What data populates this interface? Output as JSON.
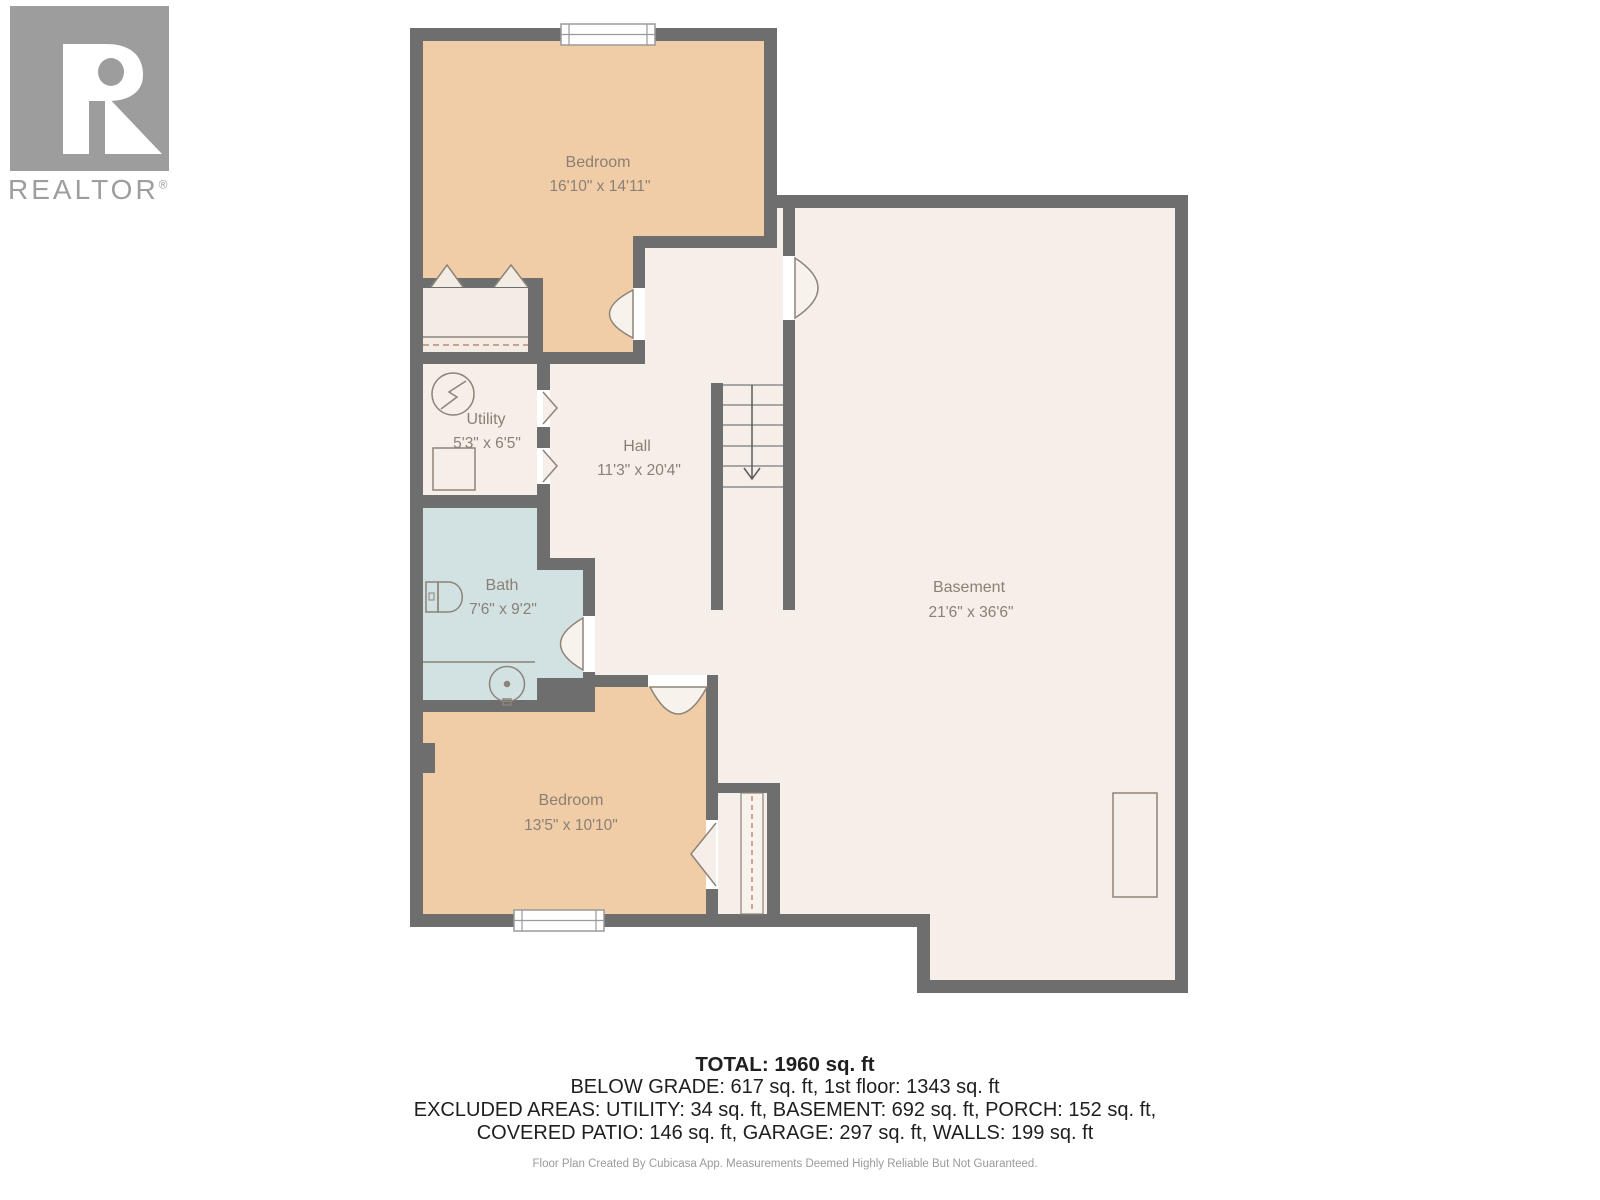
{
  "logo": {
    "brand": "REALTOR",
    "registered": "®"
  },
  "rooms": {
    "bedroom1": {
      "name": "Bedroom",
      "dims": "16'10\" x 14'11\""
    },
    "utility": {
      "name": "Utility",
      "dims": "5'3\" x 6'5\""
    },
    "hall": {
      "name": "Hall",
      "dims": "11'3\" x 20'4\""
    },
    "bath": {
      "name": "Bath",
      "dims": "7'6\" x 9'2\""
    },
    "bedroom2": {
      "name": "Bedroom",
      "dims": "13'5\" x 10'10\""
    },
    "basement": {
      "name": "Basement",
      "dims": "21'6\" x 36'6\""
    }
  },
  "summary": {
    "total": "TOTAL: 1960 sq. ft",
    "line2": "BELOW GRADE: 617 sq. ft, 1st floor: 1343 sq. ft",
    "line3": "EXCLUDED AREAS: UTILITY: 34 sq. ft, BASEMENT: 692 sq. ft, PORCH: 152 sq. ft,",
    "line4": "COVERED PATIO: 146 sq. ft, GARAGE: 297 sq. ft, WALLS: 199 sq. ft"
  },
  "footer": {
    "disclaimer": "Floor Plan Created By Cubicasa App. Measurements Deemed Highly Reliable But Not Guaranteed."
  },
  "colors": {
    "wall": "#6e6e6e",
    "floor_cream": "#f6eee8",
    "floor_peach": "#f0cda6",
    "floor_bath": "#d2e1e2",
    "label_text": "#8a8076",
    "logo_gray": "#9d9d9d"
  }
}
